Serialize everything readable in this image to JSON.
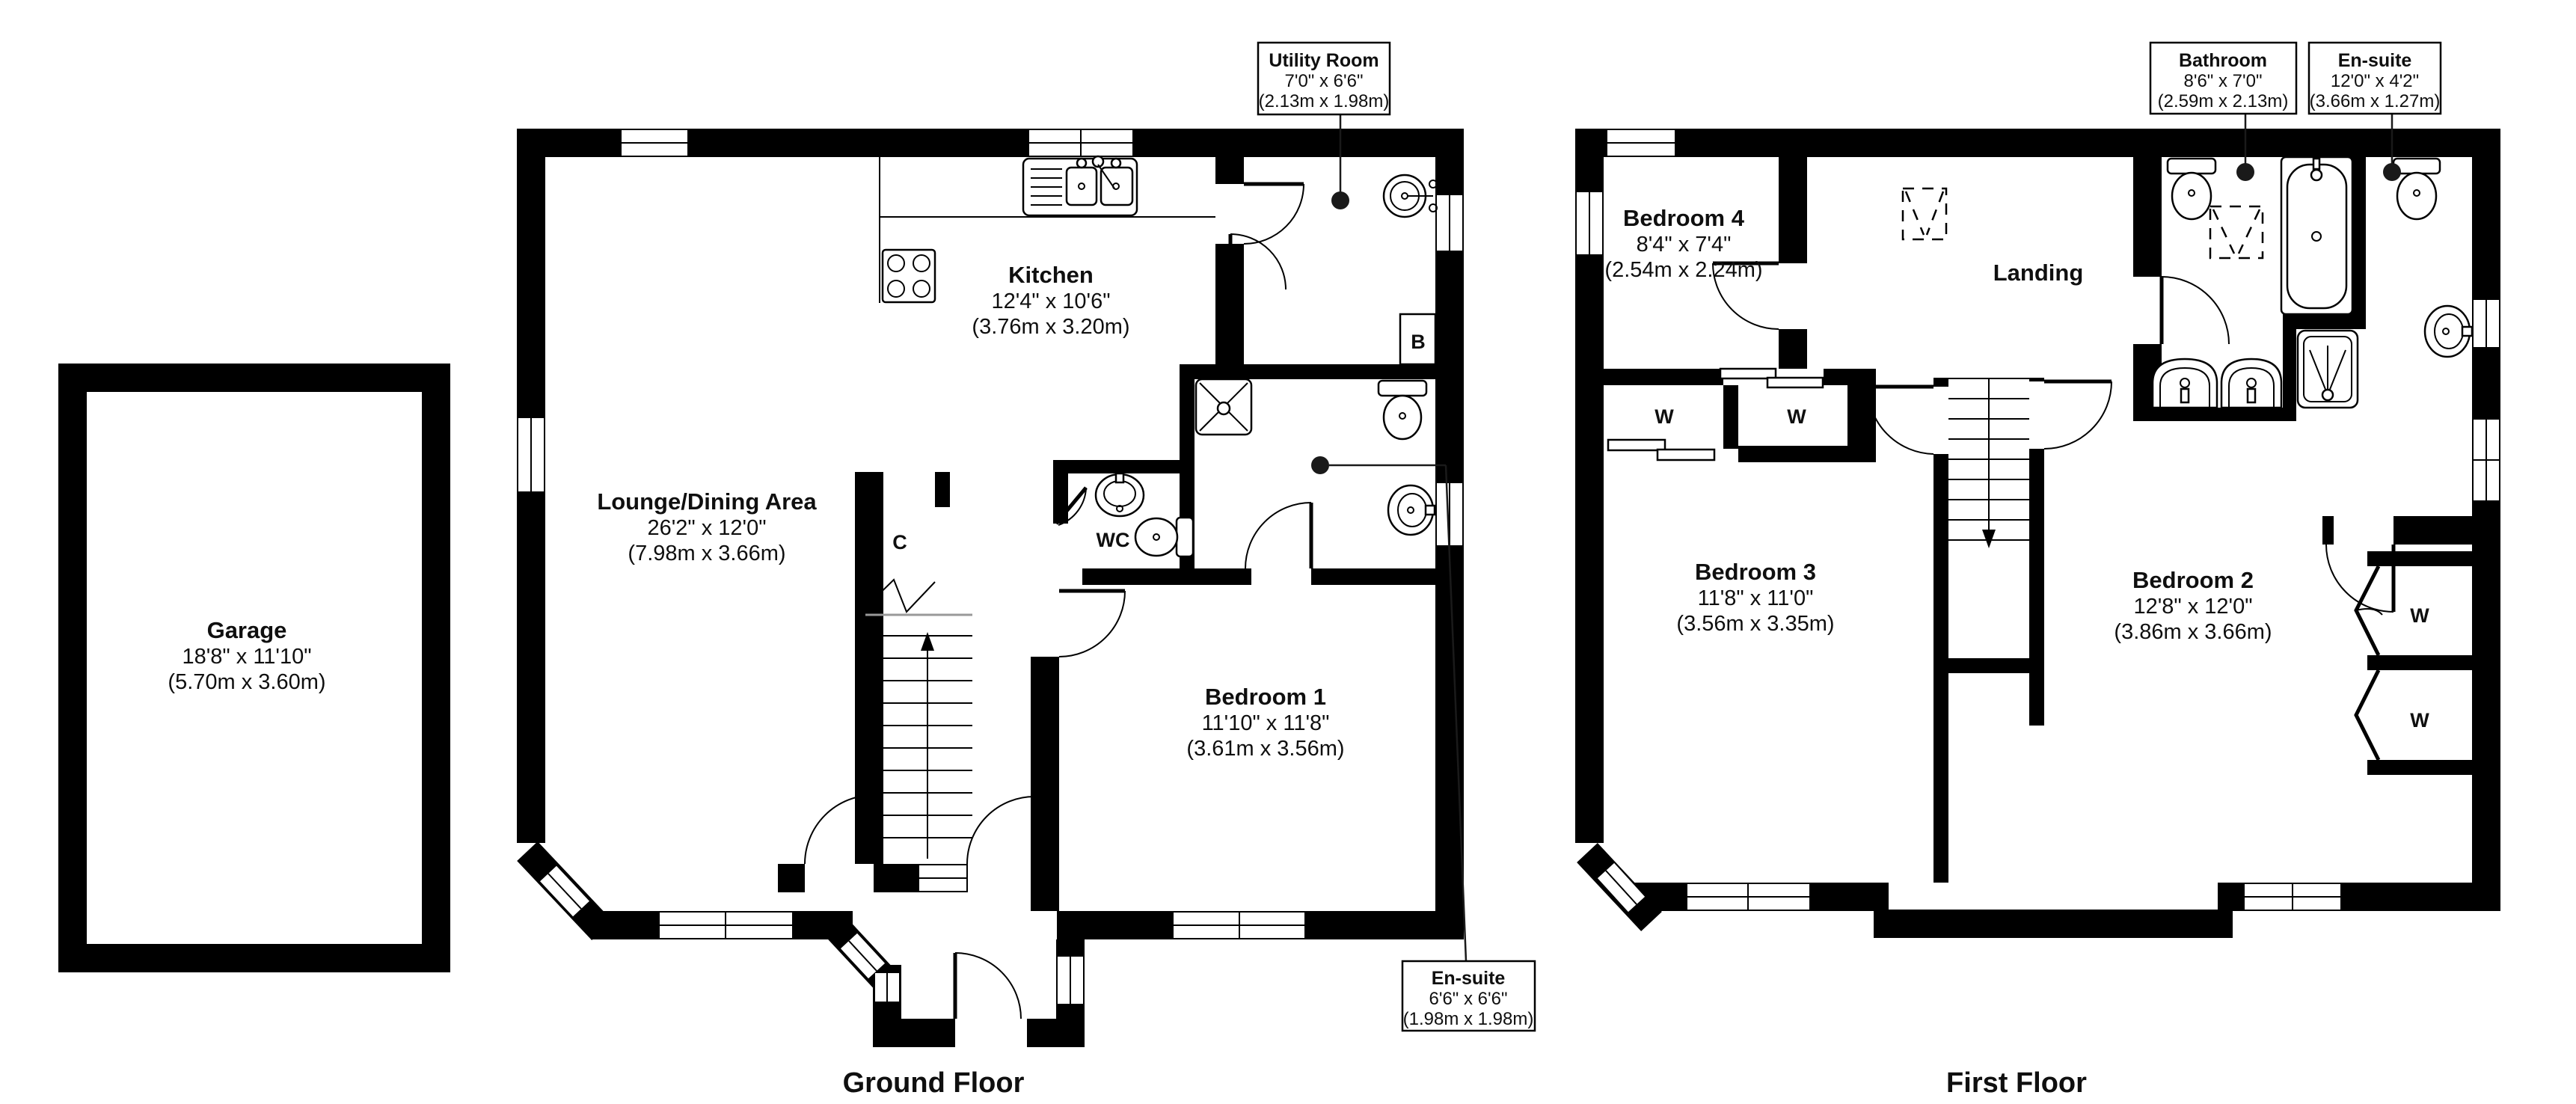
{
  "document": {
    "type": "floorplan",
    "background": "#ffffff",
    "wall_color": "#000000",
    "leader_color": "#1a1a1a"
  },
  "floors": {
    "ground_title": "Ground Floor",
    "first_title": "First Floor"
  },
  "ground": {
    "garage": {
      "name": "Garage",
      "imperial": "18'8\" x 11'10\"",
      "metric": "(5.70m x 3.60m)"
    },
    "lounge": {
      "name": "Lounge/Dining Area",
      "imperial": "26'2\" x 12'0\"",
      "metric": "(7.98m x 3.66m)"
    },
    "kitchen": {
      "name": "Kitchen",
      "imperial": "12'4\" x 10'6\"",
      "metric": "(3.76m x 3.20m)"
    },
    "bedroom1": {
      "name": "Bedroom 1",
      "imperial": "11'10\" x 11'8\"",
      "metric": "(3.61m x 3.56m)"
    },
    "wc_label": "WC",
    "cupboard_label": "C",
    "boiler_label": "B",
    "callout_utility": {
      "title": "Utility Room",
      "imperial": "7'0\" x 6'6\"",
      "metric": "(2.13m x 1.98m)"
    },
    "callout_ensuite": {
      "title": "En-suite",
      "imperial": "6'6\" x 6'6\"",
      "metric": "(1.98m x 1.98m)"
    }
  },
  "first": {
    "bedroom4": {
      "name": "Bedroom 4",
      "imperial": "8'4\" x 7'4\"",
      "metric": "(2.54m x 2.24m)"
    },
    "bedroom3": {
      "name": "Bedroom 3",
      "imperial": "11'8\" x 11'0\"",
      "metric": "(3.56m x 3.35m)"
    },
    "bedroom2": {
      "name": "Bedroom 2",
      "imperial": "12'8\" x 12'0\"",
      "metric": "(3.86m x 3.66m)"
    },
    "landing": {
      "name": "Landing"
    },
    "wardrobe_label": "W",
    "callout_bathroom": {
      "title": "Bathroom",
      "imperial": "8'6\" x 7'0\"",
      "metric": "(2.59m x 2.13m)"
    },
    "callout_ensuite": {
      "title": "En-suite",
      "imperial": "12'0\" x 4'2\"",
      "metric": "(3.66m x 1.27m)"
    }
  }
}
